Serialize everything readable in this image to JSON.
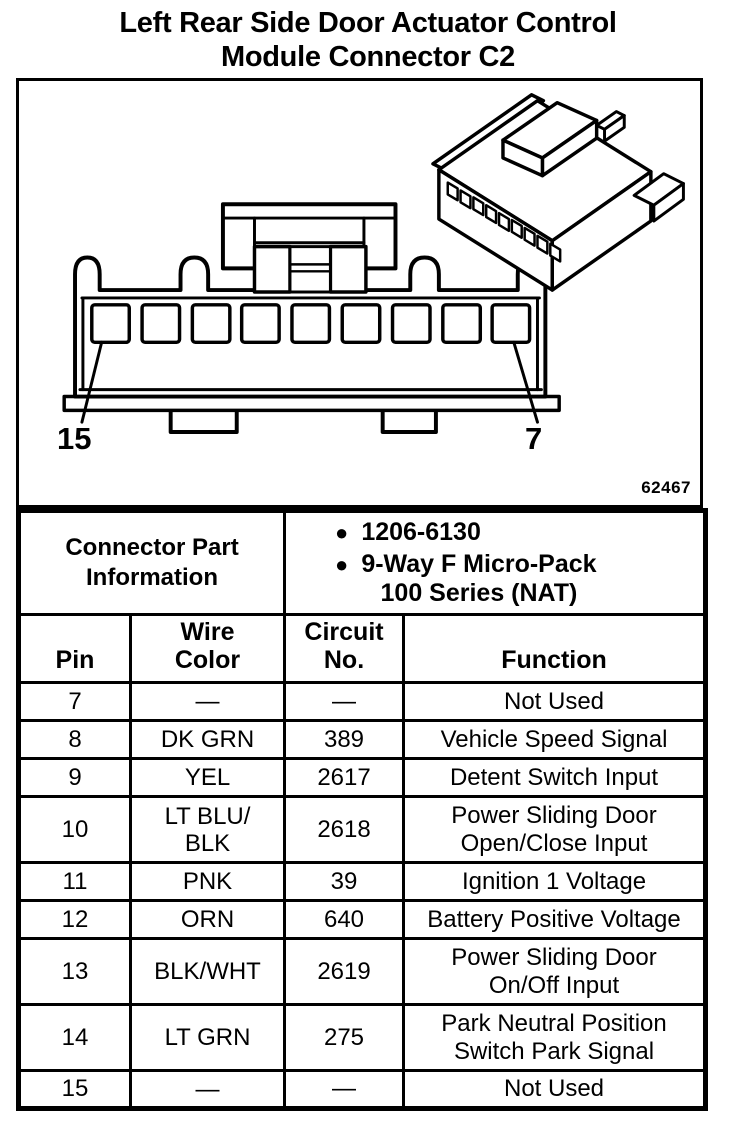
{
  "page": {
    "title": "Left Rear Side Door Actuator Control\nModule Connector C2"
  },
  "figure": {
    "number": "62467",
    "callout_left": "15",
    "callout_right": "7"
  },
  "part_info": {
    "label": "Connector Part\nInformation",
    "bullets": [
      "1206-6130",
      "9-Way F Micro-Pack\n100 Series (NAT)"
    ]
  },
  "pin_table": {
    "headers": {
      "pin": "Pin",
      "wire_color": "Wire\nColor",
      "circuit_no": "Circuit\nNo.",
      "function": "Function"
    },
    "rows": [
      {
        "pin": "7",
        "wire_color": "—",
        "circuit_no": "—",
        "function": "Not Used"
      },
      {
        "pin": "8",
        "wire_color": "DK GRN",
        "circuit_no": "389",
        "function": "Vehicle Speed Signal"
      },
      {
        "pin": "9",
        "wire_color": "YEL",
        "circuit_no": "2617",
        "function": "Detent Switch Input"
      },
      {
        "pin": "10",
        "wire_color": "LT BLU/\nBLK",
        "circuit_no": "2618",
        "function": "Power Sliding Door\nOpen/Close Input"
      },
      {
        "pin": "11",
        "wire_color": "PNK",
        "circuit_no": "39",
        "function": "Ignition 1 Voltage"
      },
      {
        "pin": "12",
        "wire_color": "ORN",
        "circuit_no": "640",
        "function": "Battery Positive Voltage"
      },
      {
        "pin": "13",
        "wire_color": "BLK/WHT",
        "circuit_no": "2619",
        "function": "Power Sliding Door\nOn/Off Input"
      },
      {
        "pin": "14",
        "wire_color": "LT GRN",
        "circuit_no": "275",
        "function": "Park Neutral Position\nSwitch Park Signal"
      },
      {
        "pin": "15",
        "wire_color": "—",
        "circuit_no": "—",
        "function": "Not Used"
      }
    ]
  }
}
